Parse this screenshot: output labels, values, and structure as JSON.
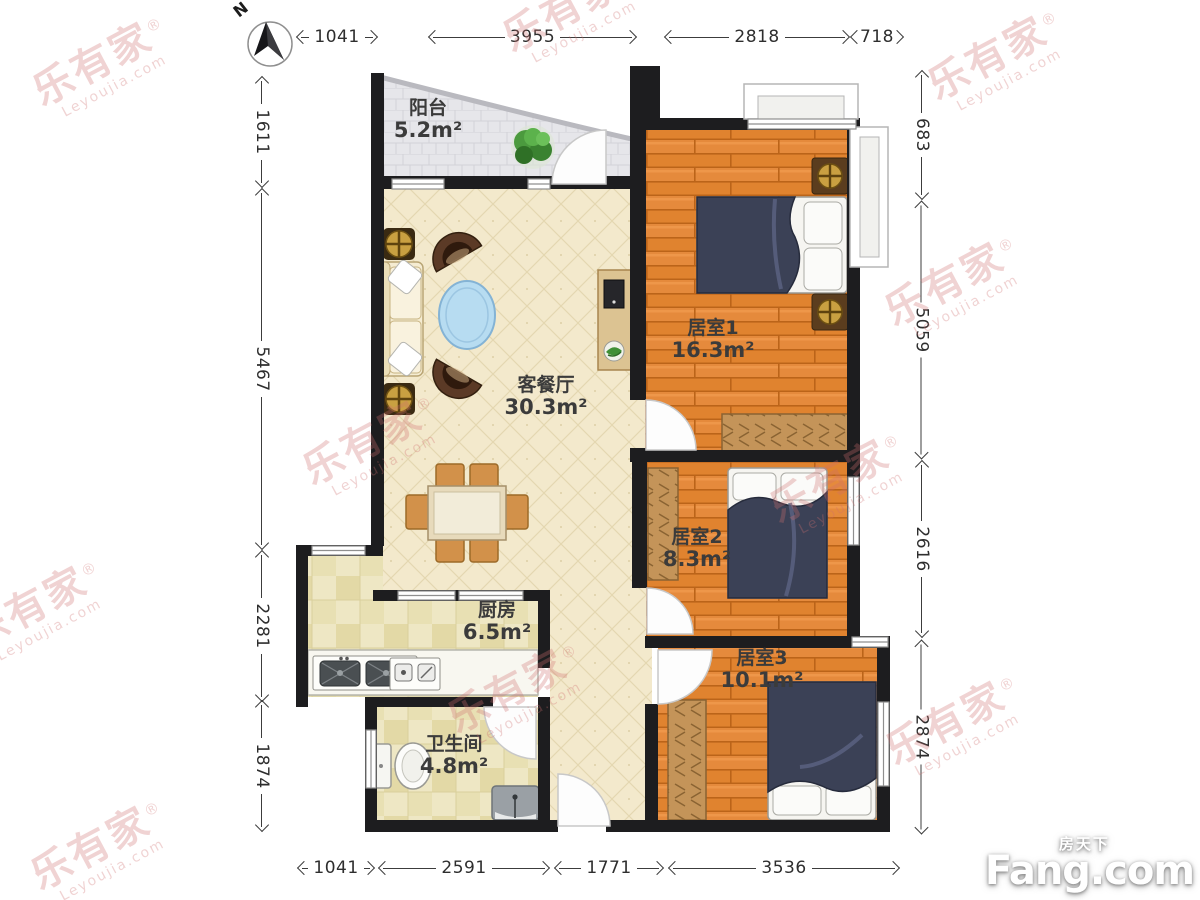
{
  "compass": {
    "label": "N"
  },
  "rooms": [
    {
      "name": "阳台",
      "area": "5.2m²"
    },
    {
      "name": "客餐厅",
      "area": "30.3m²"
    },
    {
      "name": "居室1",
      "area": "16.3m²"
    },
    {
      "name": "居室2",
      "area": "8.3m²"
    },
    {
      "name": "居室3",
      "area": "10.1m²"
    },
    {
      "name": "厨房",
      "area": "6.5m²"
    },
    {
      "name": "卫生间",
      "area": "4.8m²"
    }
  ],
  "dimensions_mm": {
    "top": [
      "1041",
      "3955",
      "2818",
      "718"
    ],
    "bottom": [
      "1041",
      "2591",
      "1771",
      "3536"
    ],
    "left": [
      "1611",
      "5467",
      "2281",
      "1874"
    ],
    "right": [
      "683",
      "5059",
      "2616",
      "2874"
    ]
  },
  "watermark": {
    "brand": "乐有家",
    "registered": "®",
    "domain": "Leyoujia.com"
  },
  "logo": {
    "cn": "房天下",
    "en": "Fang.com"
  },
  "colors": {
    "wall": "#1d1d1f",
    "wood_floor": "#e0832f",
    "cream_floor": "#f3e9cc",
    "tile_floor": "#eee7c4",
    "balcony_floor": "#e6e6ea",
    "bed": "#3b4156",
    "watermark": "#cf6f6f"
  }
}
